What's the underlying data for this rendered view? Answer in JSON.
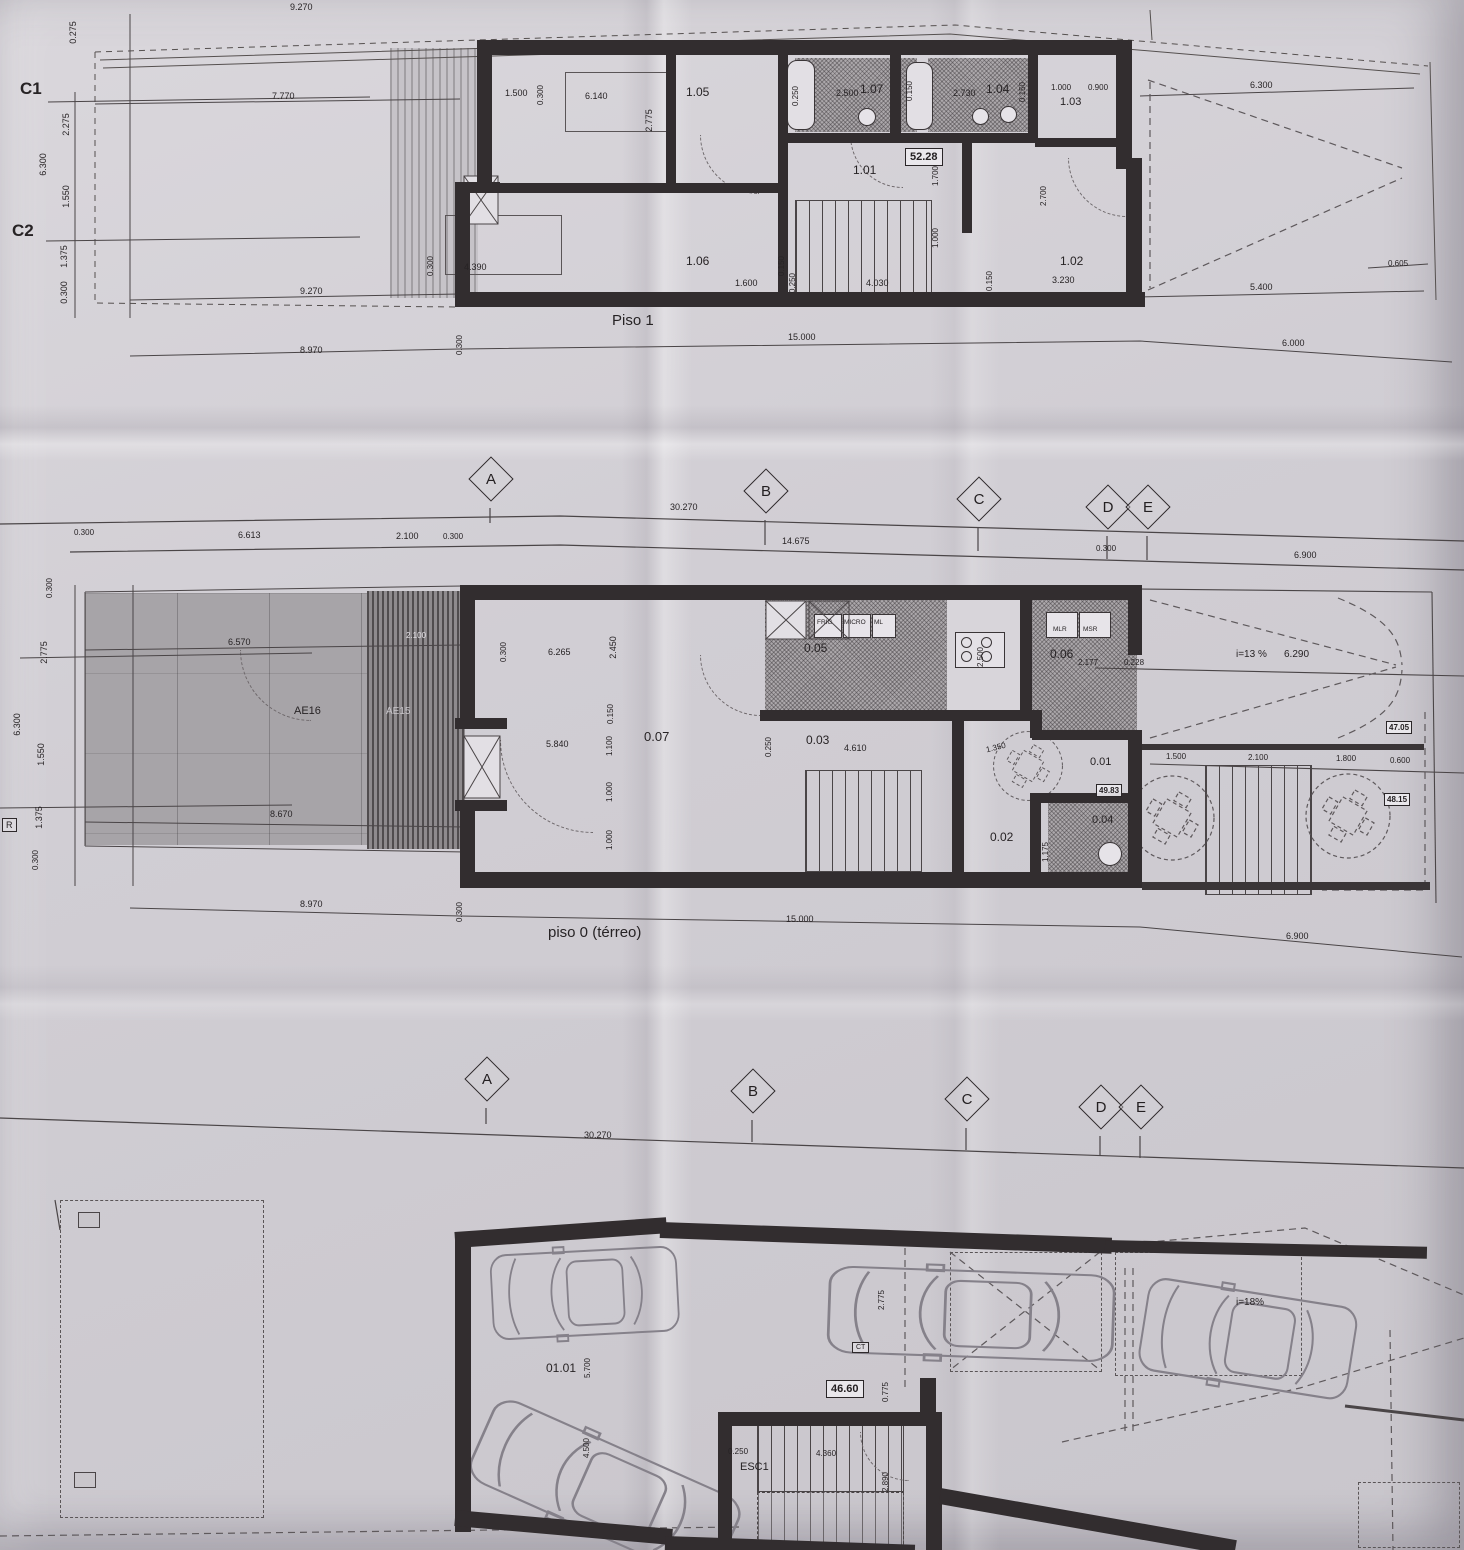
{
  "sheet": {
    "description_note": "scanned architectural floor plans"
  },
  "piso1": {
    "title": "Piso 1",
    "grid_c1": "C1",
    "grid_c2": "C2",
    "area_badge": "52.28",
    "rooms": {
      "r101": "1.01",
      "r102": "1.02",
      "r103": "1.03",
      "r104": "1.04",
      "r105": "1.05",
      "r106": "1.06",
      "r107": "1.07"
    },
    "dims": {
      "top_9270": "9.270",
      "left_7770": "7.770",
      "v_0275": "0.275",
      "v_2275": "2.275",
      "v_6300": "6.300",
      "v_1550": "1.550",
      "v_1375": "1.375",
      "v_0300": "0.300",
      "mid_9270": "9.270",
      "base_8970": "8.970",
      "base_0300": "0.300",
      "base_15000": "15.000",
      "base_6000": "6.000",
      "d_1500": "1.500",
      "d_0300": "0.300",
      "d_6140": "6.140",
      "d_2775": "2.775",
      "d_0250a": "0.250",
      "d_2500": "2.500",
      "d_0150a": "0.150",
      "d_2730": "2.730",
      "d_0150b": "0.150",
      "d_1000": "1.000",
      "d_0900": "0.900",
      "d_6300r": "6.300",
      "d_1700": "1.700",
      "d_2700": "2.700",
      "d_1000b": "1.000",
      "d_0300b": "0.300",
      "d_4390": "4.390",
      "d_0150c": "0.150",
      "d_1600": "1.600",
      "d_0250b": "0.250",
      "d_4030": "4.030",
      "d_0150d": "0.150",
      "d_3230": "3.230",
      "d_5400": "5.400",
      "d_0605": "0.605"
    }
  },
  "grid": {
    "a": "A",
    "b": "B",
    "c": "C",
    "d": "D",
    "e": "E",
    "d_30270": "30.270",
    "d_0300a": "0.300",
    "d_6613": "6.613",
    "d_2100": "2.100",
    "d_0300b": "0.300",
    "d_14675": "14.675",
    "d_0300c": "0.300",
    "d_6900": "6.900"
  },
  "piso0": {
    "title": "piso 0 (térreo)",
    "zones": {
      "ae16": "AE16",
      "ae15": "AE15",
      "r_box": "R"
    },
    "rooms": {
      "r001": "0.01",
      "r002": "0.02",
      "r003": "0.03",
      "r004": "0.04",
      "r005": "0.05",
      "r006": "0.06",
      "r007": "0.07"
    },
    "badges": {
      "b4705": "47.05",
      "b4815": "48.15",
      "b4983": "49.83"
    },
    "appliances": {
      "frig": "FRIG",
      "micro": "MICRO",
      "ml": "ML",
      "mlr": "MLR",
      "msr": "MSR"
    },
    "ramp_slope": "i=13 %",
    "ramp_len": "6.290",
    "dims": {
      "d_6570": "6.570",
      "d_2100t": "2.100",
      "d_8670": "8.670",
      "v_0300a": "0.300",
      "v_2775": "2.775",
      "v_6300": "6.300",
      "v_1550": "1.550",
      "v_1375": "1.375",
      "v_0300b": "0.300",
      "d_0300h": "0.300",
      "d_6265": "6.265",
      "d_2450": "2.450",
      "d_5840": "5.840",
      "d_0150": "0.150",
      "d_1100": "1.100",
      "d_1000a": "1.000",
      "d_1000b": "1.000",
      "d_2500": "2.500",
      "d_2177": "2.177",
      "d_0228": "0.228",
      "d_4610": "4.610",
      "d_0250": "0.250",
      "d_1350": "1.350",
      "d_1175": "1.175",
      "d_1500": "1.500",
      "d_2100b": "2.100",
      "d_1800": "1.800",
      "d_0600": "0.600",
      "base_8970": "8.970",
      "base_0300": "0.300",
      "base_15000": "15.000",
      "base_6900": "6.900"
    }
  },
  "garage": {
    "room": "01.01",
    "esc": "ESC1",
    "ct": "CT",
    "area_badge": "46.60",
    "ramp_slope": "i=18%",
    "dims": {
      "d_5700": "5.700",
      "d_4500": "4.500",
      "d_0250": "0.250",
      "d_4360": "4.360",
      "d_2890": "2.890",
      "d_2775": "2.775",
      "d_0775": "0.775"
    }
  }
}
